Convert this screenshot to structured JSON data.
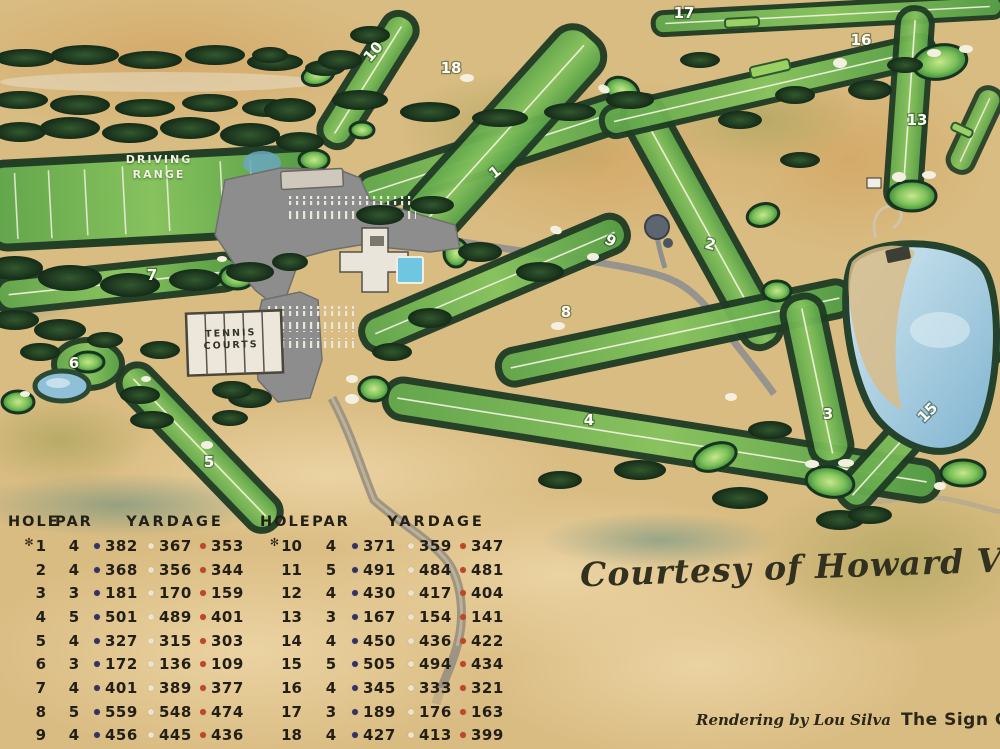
{
  "map": {
    "driving_range_label_line1": "DRIVING",
    "driving_range_label_line2": "RANGE",
    "tennis_label_line1": "TENNIS",
    "tennis_label_line2": "COURTS",
    "hole_markers": [
      {
        "label": "1",
        "x": 498,
        "y": 176,
        "rot": -38
      },
      {
        "label": "2",
        "x": 709,
        "y": 249,
        "rot": 15
      },
      {
        "label": "3",
        "x": 828,
        "y": 419,
        "rot": 0
      },
      {
        "label": "4",
        "x": 589,
        "y": 425,
        "rot": 0
      },
      {
        "label": "5",
        "x": 209,
        "y": 467,
        "rot": 0
      },
      {
        "label": "6",
        "x": 74,
        "y": 368,
        "rot": 0
      },
      {
        "label": "7",
        "x": 152,
        "y": 280,
        "rot": 0
      },
      {
        "label": "8",
        "x": 566,
        "y": 317,
        "rot": 0
      },
      {
        "label": "9",
        "x": 608,
        "y": 245,
        "rot": 30
      },
      {
        "label": "10",
        "x": 377,
        "y": 55,
        "rot": -50
      },
      {
        "label": "13",
        "x": 917,
        "y": 125,
        "rot": 0
      },
      {
        "label": "15",
        "x": 931,
        "y": 416,
        "rot": -45
      },
      {
        "label": "16",
        "x": 861,
        "y": 45,
        "rot": 0
      },
      {
        "label": "17",
        "x": 684,
        "y": 18,
        "rot": 0
      },
      {
        "label": "18",
        "x": 451,
        "y": 73,
        "rot": 0
      }
    ]
  },
  "scorecard": {
    "headers": {
      "hole": "HOLE",
      "par": "PAR",
      "yardage": "YARDAGE"
    },
    "star_symbol": "✻",
    "dot_colors": [
      "#323269",
      "#ece4cc",
      "#bf4626"
    ],
    "front_nine": [
      {
        "hole": "1",
        "star": true,
        "par": "4",
        "yards": [
          "382",
          "367",
          "353"
        ]
      },
      {
        "hole": "2",
        "star": false,
        "par": "4",
        "yards": [
          "368",
          "356",
          "344"
        ]
      },
      {
        "hole": "3",
        "star": false,
        "par": "3",
        "yards": [
          "181",
          "170",
          "159"
        ]
      },
      {
        "hole": "4",
        "star": false,
        "par": "5",
        "yards": [
          "501",
          "489",
          "401"
        ]
      },
      {
        "hole": "5",
        "star": false,
        "par": "4",
        "yards": [
          "327",
          "315",
          "303"
        ]
      },
      {
        "hole": "6",
        "star": false,
        "par": "3",
        "yards": [
          "172",
          "136",
          "109"
        ]
      },
      {
        "hole": "7",
        "star": false,
        "par": "4",
        "yards": [
          "401",
          "389",
          "377"
        ]
      },
      {
        "hole": "8",
        "star": false,
        "par": "5",
        "yards": [
          "559",
          "548",
          "474"
        ]
      },
      {
        "hole": "9",
        "star": false,
        "par": "4",
        "yards": [
          "456",
          "445",
          "436"
        ]
      }
    ],
    "back_nine": [
      {
        "hole": "10",
        "star": true,
        "par": "4",
        "yards": [
          "371",
          "359",
          "347"
        ]
      },
      {
        "hole": "11",
        "star": false,
        "par": "5",
        "yards": [
          "491",
          "484",
          "481"
        ]
      },
      {
        "hole": "12",
        "star": false,
        "par": "4",
        "yards": [
          "430",
          "417",
          "404"
        ]
      },
      {
        "hole": "13",
        "star": false,
        "par": "3",
        "yards": [
          "167",
          "154",
          "141"
        ]
      },
      {
        "hole": "14",
        "star": false,
        "par": "4",
        "yards": [
          "450",
          "436",
          "422"
        ]
      },
      {
        "hole": "15",
        "star": false,
        "par": "5",
        "yards": [
          "505",
          "494",
          "434"
        ]
      },
      {
        "hole": "16",
        "star": false,
        "par": "4",
        "yards": [
          "345",
          "333",
          "321"
        ]
      },
      {
        "hole": "17",
        "star": false,
        "par": "3",
        "yards": [
          "189",
          "176",
          "163"
        ]
      },
      {
        "hole": "18",
        "star": false,
        "par": "4",
        "yards": [
          "427",
          "413",
          "399"
        ]
      }
    ]
  },
  "credits": {
    "courtesy": "Courtesy of Howard Van Pelt",
    "rendering_by": "Rendering by Lou Silva",
    "studio": "The Sign Center"
  },
  "colors": {
    "sand": "#d9bc82",
    "fairway": "#6ab04f",
    "trees": "#1d3a22",
    "water": "#9ec4da",
    "asphalt": "#8d8d8d"
  }
}
